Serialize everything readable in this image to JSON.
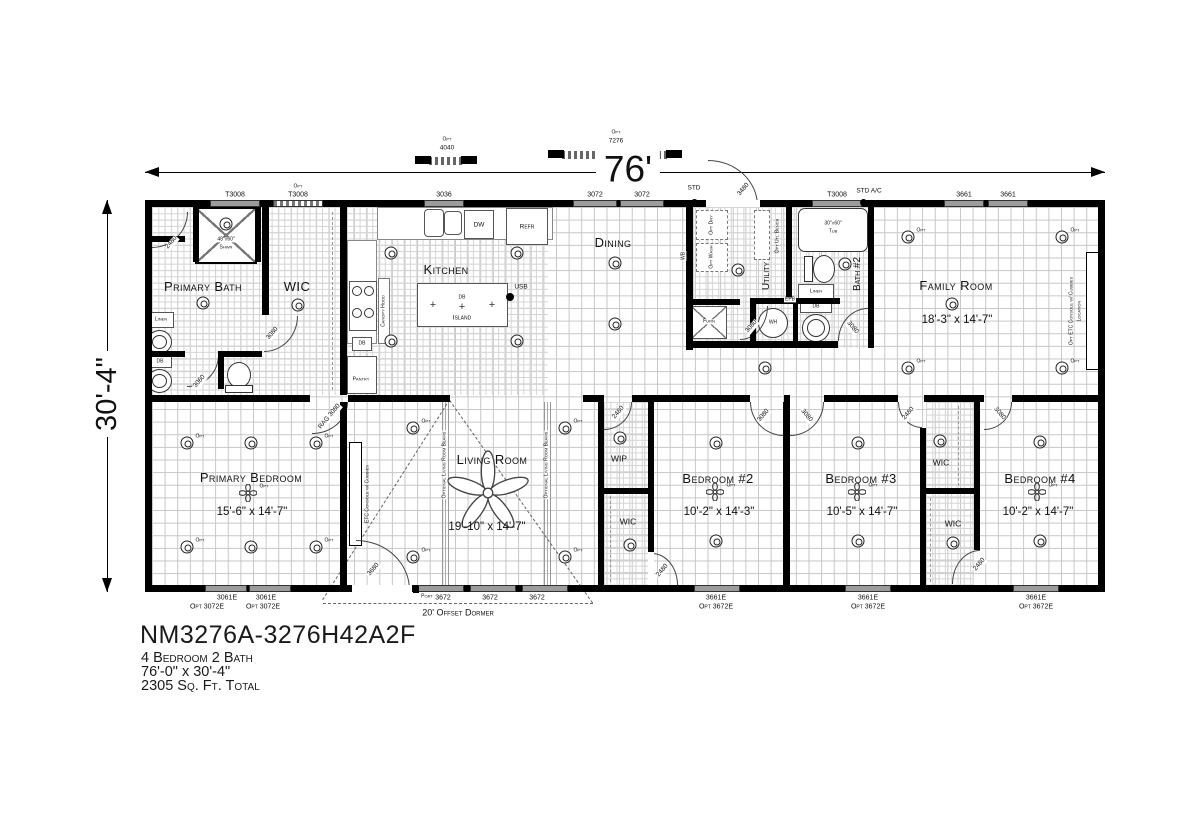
{
  "colors": {
    "wall": "#000000",
    "window": "#9c9c9c",
    "grid": "#c6c6c6",
    "background": "#ffffff"
  },
  "dimension": {
    "width": "76'",
    "height": "30'-4\""
  },
  "opt_windows_top": {
    "opt1_label": "Opt",
    "opt1_size": "4040",
    "opt2_label": "Opt",
    "opt2_size": "7276"
  },
  "top_wall": {
    "win_t3008": "T3008",
    "opt": "Opt",
    "win_opt_t3008": "T3008",
    "win_3036": "3036",
    "win_3072a": "3072",
    "win_3072b": "3072",
    "std": "STD",
    "door_3480": "3480",
    "win_t3008b": "T3008",
    "std_ac": "STD A/C",
    "win_3661a": "3661",
    "win_3661b": "3661"
  },
  "primary_bath": {
    "name": "Primary Bath",
    "shower_size": "48\"x60\"",
    "shower": "Shwr",
    "linen": "Linen",
    "db": "DB",
    "door_2480": "2480",
    "door_3080": "3080",
    "door_3060": "3060"
  },
  "primary_wic": {
    "name": "WIC"
  },
  "kitchen": {
    "name": "Kitchen",
    "canopy": "Canopy Hood",
    "db": "DB",
    "pantry": "Pantry",
    "island": "Island",
    "island_db": "DB",
    "usb": "USB",
    "dw": "DW",
    "refr": "Refr"
  },
  "dining": {
    "name": "Dining"
  },
  "utility": {
    "name": "Utility",
    "wb": "WB",
    "opt_dry_l1": "Opt",
    "opt_dry_l2": "Dry",
    "opt_wash_l1": "Opt",
    "opt_wash_l2": "Wash",
    "bench": "Opt Utl Bench",
    "furn": "Furn",
    "epb": "EPB",
    "wh": "WH",
    "door_3080": "3080"
  },
  "bath2": {
    "name": "Bath #2",
    "tub_size": "30\"x60\"",
    "tub": "Tub",
    "linen": "Linen",
    "db": "DB",
    "door_3080": "3080"
  },
  "family_room": {
    "name": "Family Room",
    "dims": "18'-3\" x 14'-7\"",
    "console_l1": "Opt ETC Console w/ Cubbies",
    "console_l2": "Location"
  },
  "primary_bedroom": {
    "name": "Primary Bedroom",
    "dims": "15'-6\" x 14'-7\"",
    "rag": "RAG",
    "rag_door": "3080"
  },
  "living_room": {
    "name": "Living Room",
    "dims": "19'-10\" x 14'-7\"",
    "console": "ETC Console w/ Cubbies",
    "beam": "Optional Living Room Beams",
    "door_3680": "3680",
    "port": "Port",
    "dormer": "20' Offset Dormer"
  },
  "wip": {
    "name": "WIP",
    "door_2480": "2480"
  },
  "hall_wic": {
    "name": "WIC",
    "door_2480": "2480"
  },
  "bedroom2": {
    "name": "Bedroom #2",
    "dims": "10'-2\" x 14'-3\"",
    "door_3080": "3080"
  },
  "bedroom3": {
    "name": "Bedroom #3",
    "dims": "10'-5\" x 14'-7\"",
    "door_3080": "3080",
    "wic_door_2480": "2480"
  },
  "wic3": {
    "name": "WIC"
  },
  "wic4": {
    "name": "WIC",
    "door_2480": "2480"
  },
  "bedroom4": {
    "name": "Bedroom #4",
    "dims": "10'-2\" x 14'-7\"",
    "door_3080": "3080"
  },
  "bottom_wall": {
    "win_3061e_a": "3061E",
    "win_3061e_b": "3061E",
    "opt_3072e_a": "Opt 3072E",
    "opt_3072e_b": "Opt 3072E",
    "win_3672_a": "3672",
    "win_3672_b": "3672",
    "win_3672_c": "3672",
    "win_3661e_b2": "3661E",
    "opt_3672e_b2": "Opt 3672E",
    "win_3661e_b3": "3661E",
    "opt_3672e_b3": "Opt 3672E",
    "win_3661e_b4": "3661E",
    "opt_3672e_b4": "Opt 3672E"
  },
  "misc": {
    "opt": "Opt"
  },
  "title_block": {
    "model": "NM3276A-3276H42A2F",
    "beds_baths": "4 Bedroom 2 Bath",
    "size": "76'-0\" x 30'-4\"",
    "sqft": "2305 Sq. Ft. Total"
  }
}
